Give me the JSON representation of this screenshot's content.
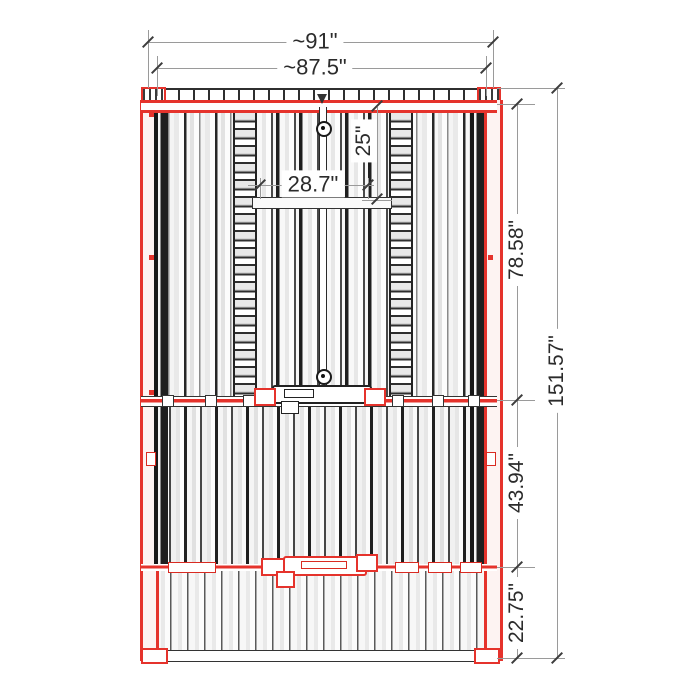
{
  "drawing": {
    "description": "sauna-cabin-plan-with-dimensions",
    "colors": {
      "frame_red": "#e5332c",
      "line_dark": "#2b2b2b",
      "dim_gray": "#9a9a9a",
      "background": "#ffffff"
    }
  },
  "dimensions": {
    "overall_width": "~91\"",
    "inner_width": "~87.5\"",
    "opening_width": "28.7\"",
    "opening_offset": "25\"",
    "upper_section_length": "78.58\"",
    "middle_section_length": "43.94\"",
    "lower_section_length": "22.75\"",
    "overall_length": "151.57\""
  }
}
